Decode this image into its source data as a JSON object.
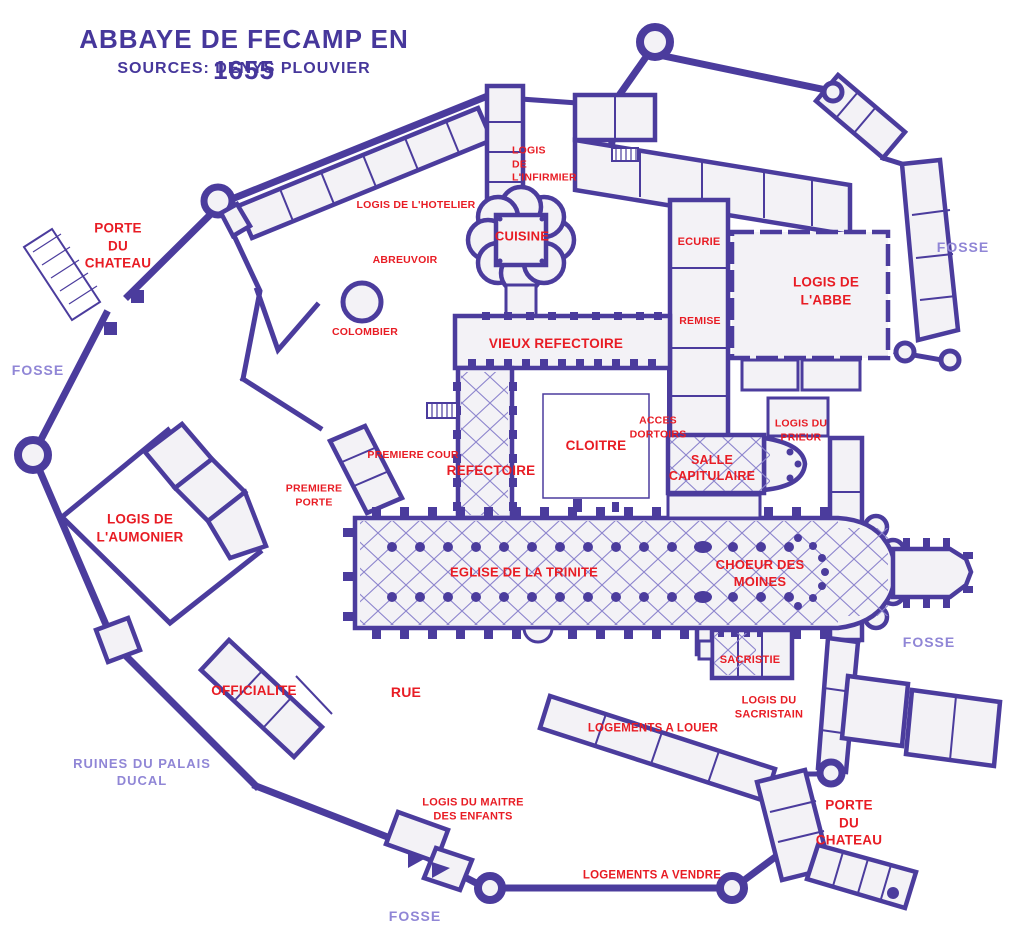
{
  "header": {
    "title": "ABBAYE DE FECAMP EN 1655",
    "subtitle": "SOURCES: DENYS PLOUVIER"
  },
  "colors": {
    "wall": "#4b3c9d",
    "rib": "#8d85cd",
    "building_fill": "#f3f2f6",
    "red": "#e81c24",
    "lavender": "#9086d6",
    "title": "#46379b",
    "background": "#ffffff"
  },
  "labels": [
    {
      "id": "porte-du-chateau-west",
      "text": "PORTE\nDU\nCHATEAU",
      "x": 118,
      "y": 246,
      "size": 13.5,
      "color": "red"
    },
    {
      "id": "fosse-west",
      "text": "FOSSE",
      "x": 38,
      "y": 370,
      "size": 14,
      "color": "lavender"
    },
    {
      "id": "logis-de-l-aumonier",
      "text": "LOGIS DE\nL'AUMONIER",
      "x": 140,
      "y": 528,
      "size": 13.5,
      "color": "red"
    },
    {
      "id": "officialite",
      "text": "OFFICIALITE",
      "x": 254,
      "y": 691,
      "size": 13.5,
      "color": "red"
    },
    {
      "id": "ruines-du-palais-ducal",
      "text": "RUINES DU PALAIS\nDUCAL",
      "x": 142,
      "y": 773,
      "size": 13,
      "color": "lavender"
    },
    {
      "id": "rue",
      "text": "RUE",
      "x": 406,
      "y": 692,
      "size": 14,
      "color": "red"
    },
    {
      "id": "logis-du-maitre-des-enfants",
      "text": "LOGIS DU MAITRE\nDES ENFANTS",
      "x": 473,
      "y": 810,
      "size": 11,
      "color": "red"
    },
    {
      "id": "fosse-south",
      "text": "FOSSE",
      "x": 415,
      "y": 916,
      "size": 14,
      "color": "lavender"
    },
    {
      "id": "logements-a-vendre",
      "text": "LOGEMENTS A VENDRE",
      "x": 652,
      "y": 876,
      "size": 11.5,
      "color": "red"
    },
    {
      "id": "porte-du-chateau-southeast",
      "text": "PORTE\nDU\nCHATEAU",
      "x": 849,
      "y": 823,
      "size": 13.5,
      "color": "red"
    },
    {
      "id": "logements-a-louer",
      "text": "LOGEMENTS A LOUER",
      "x": 653,
      "y": 729,
      "size": 11.5,
      "color": "red"
    },
    {
      "id": "logis-du-sacristain",
      "text": "LOGIS DU\nSACRISTAIN",
      "x": 769,
      "y": 708,
      "size": 11,
      "color": "red"
    },
    {
      "id": "sacristie",
      "text": "SACRISTIE",
      "x": 750,
      "y": 660,
      "size": 11,
      "color": "red"
    },
    {
      "id": "fosse-east",
      "text": "FOSSE",
      "x": 929,
      "y": 642,
      "size": 14,
      "color": "lavender"
    },
    {
      "id": "choeur-des-moines",
      "text": "CHOEUR DES\nMOINES",
      "x": 760,
      "y": 574,
      "size": 13,
      "color": "red"
    },
    {
      "id": "eglise-de-la-trinite",
      "text": "EGLISE DE LA TRINITE",
      "x": 524,
      "y": 573,
      "size": 13,
      "color": "red"
    },
    {
      "id": "premiere-porte",
      "text": "PREMIERE\nPORTE",
      "x": 314,
      "y": 496,
      "size": 10.5,
      "color": "red"
    },
    {
      "id": "premiere-cour",
      "text": "PREMIERE COUR",
      "x": 413,
      "y": 456,
      "size": 10.5,
      "color": "red"
    },
    {
      "id": "refectoire",
      "text": "REFECTOIRE",
      "x": 491,
      "y": 471,
      "size": 13.5,
      "color": "red"
    },
    {
      "id": "cloitre",
      "text": "CLOITRE",
      "x": 596,
      "y": 446,
      "size": 13.5,
      "color": "red"
    },
    {
      "id": "acces-dortoirs",
      "text": "ACCES\nDORTOIRS",
      "x": 658,
      "y": 428,
      "size": 10.5,
      "color": "red"
    },
    {
      "id": "salle-capitulaire",
      "text": "SALLE\nCAPITULAIRE",
      "x": 712,
      "y": 468,
      "size": 12.5,
      "color": "red"
    },
    {
      "id": "logis-du-prieur",
      "text": "LOGIS DU\nPRIEUR",
      "x": 801,
      "y": 431,
      "size": 10.5,
      "color": "red"
    },
    {
      "id": "logis-de-l-abbe",
      "text": "LOGIS DE\nL'ABBE",
      "x": 826,
      "y": 291,
      "size": 13.5,
      "color": "red"
    },
    {
      "id": "fosse-northeast",
      "text": "FOSSE",
      "x": 963,
      "y": 247,
      "size": 14,
      "color": "lavender"
    },
    {
      "id": "remise",
      "text": "REMISE",
      "x": 700,
      "y": 322,
      "size": 10.5,
      "color": "red"
    },
    {
      "id": "ecurie",
      "text": "ECURIE",
      "x": 699,
      "y": 242,
      "size": 11,
      "color": "red"
    },
    {
      "id": "vieux-refectoire",
      "text": "VIEUX REFECTOIRE",
      "x": 556,
      "y": 344,
      "size": 13.5,
      "color": "red"
    },
    {
      "id": "cuisine",
      "text": "CUISINE",
      "x": 522,
      "y": 237,
      "size": 13,
      "color": "red"
    },
    {
      "id": "logis-de-l-infirmier",
      "text": "LOGIS\nDE\nL'INFIRMIER",
      "x": 512,
      "y": 165,
      "size": 10.5,
      "color": "red",
      "align": "left"
    },
    {
      "id": "logis-de-l-hotelier",
      "text": "LOGIS DE L'HOTELIER",
      "x": 416,
      "y": 206,
      "size": 10.5,
      "color": "red"
    },
    {
      "id": "abreuvoir",
      "text": "ABREUVOIR",
      "x": 405,
      "y": 261,
      "size": 10.5,
      "color": "red"
    },
    {
      "id": "colombier",
      "text": "COLOMBIER",
      "x": 365,
      "y": 333,
      "size": 10.5,
      "color": "red"
    }
  ]
}
